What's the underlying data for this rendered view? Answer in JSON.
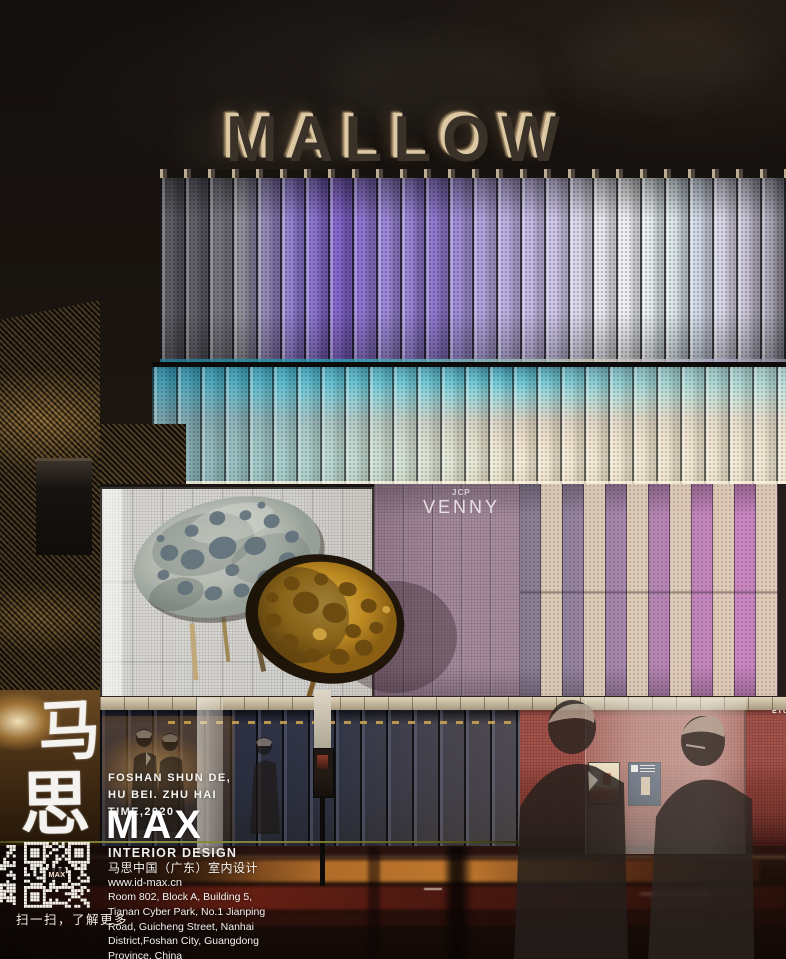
{
  "sign": {
    "text": "MALLOW"
  },
  "facade": {
    "small_label": "JCP",
    "panel_label": "VENNY",
    "edge_label": "ETC"
  },
  "branding": {
    "calligraphy": [
      "马",
      "思"
    ],
    "project_lines": [
      "FOSHAN SHUN DE,",
      "HU BEI. ZHU HAI",
      "TIME,2020"
    ],
    "logo": "MAX",
    "discipline_en": "INTERIOR DESIGN",
    "discipline_cn": "马思中国（广东）室内设计",
    "website": "www.id-max.cn",
    "address_lines": [
      "Room 802, Block A, Building 5,",
      "Tianan Cyber Park, No.1 Jianping",
      "Road, Guicheng Street, Nanhai",
      "District,Foshan City, Guangdong",
      "Province, China"
    ],
    "qr_center_label": "MAX",
    "qr_caption": "扫一扫，了解更多"
  },
  "colors": {
    "sign_glow": "#dcc9a4",
    "fin_violet": "#7e5fc8",
    "fin_cyan": "#62c2d2",
    "fin_pink": "#cb86c2",
    "street_wall_red": "#a3524a",
    "streak_orange": "#d77a2e",
    "streak_red": "#a53326",
    "divider_olive": "#7a7a2e"
  }
}
